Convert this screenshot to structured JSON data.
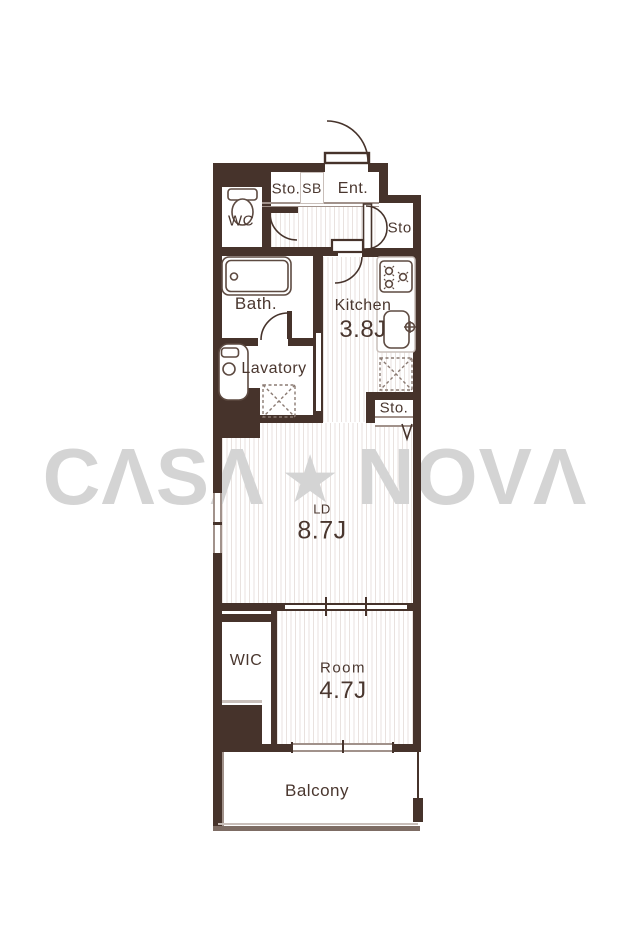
{
  "watermark": {
    "brand": "CASA NOVA",
    "left": "CΛSΛ",
    "star": "★",
    "right": "NOVΛ"
  },
  "floorplan": {
    "storage_top": {
      "label": "Sto."
    },
    "shoe_box": {
      "label": "SB"
    },
    "entrance": {
      "label": "Ent."
    },
    "storage_entrance": {
      "label": "Sto."
    },
    "wc": {
      "label": "WC"
    },
    "bath": {
      "label": "Bath."
    },
    "kitchen": {
      "label": "Kitchen",
      "area": "3.8J"
    },
    "lavatory": {
      "label": "Lavatory"
    },
    "storage_kitchen": {
      "label": "Sto."
    },
    "living_dining": {
      "label": "LD",
      "area": "8.7J"
    },
    "wic": {
      "label": "WIC"
    },
    "room": {
      "label": "Room",
      "area": "4.7J"
    },
    "balcony": {
      "label": "Balcony"
    }
  },
  "colors": {
    "wall": "#46332b",
    "text": "#4a372f",
    "hatch": "#e9e2df",
    "fixture": "#5d4a41",
    "light_line": "#a1928b",
    "outline_light": "#c9bfba",
    "watermark": "#d4d4d4",
    "background": "#ffffff"
  }
}
